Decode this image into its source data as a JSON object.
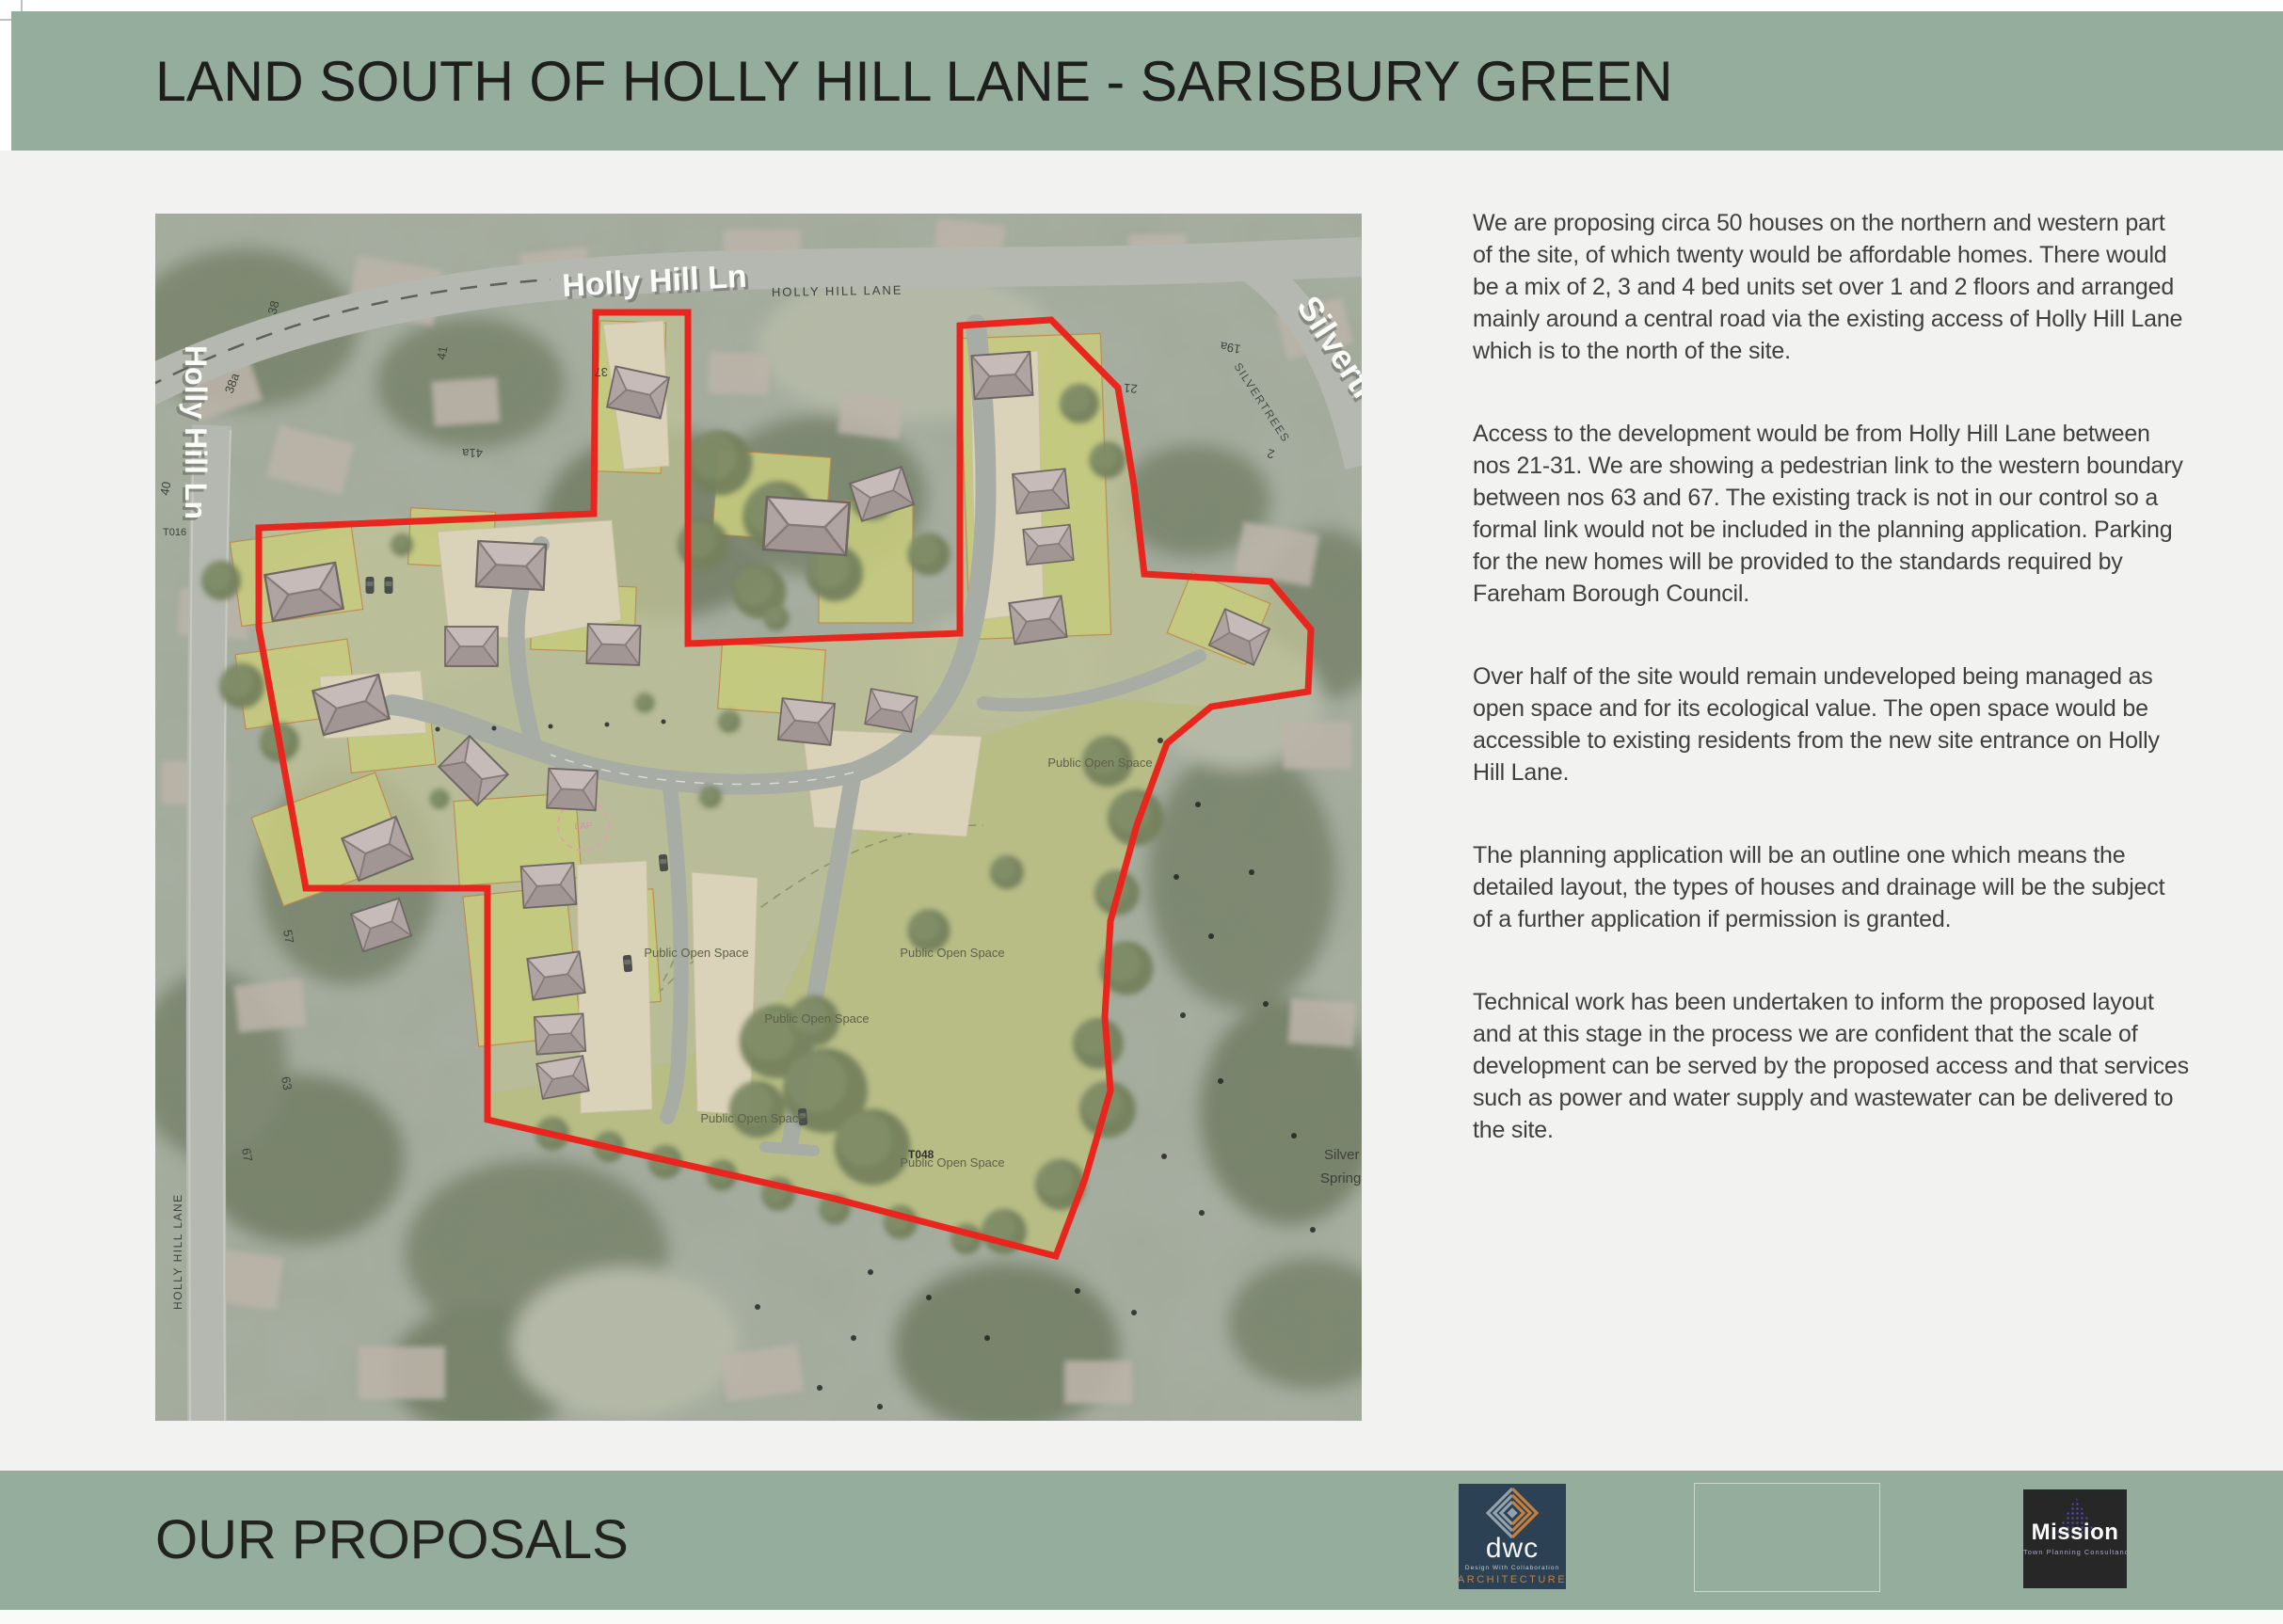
{
  "header": {
    "title": "LAND SOUTH OF HOLLY HILL LANE - SARISBURY GREEN"
  },
  "footer": {
    "title": "OUR PROPOSALS"
  },
  "proposals": {
    "paragraphs": [
      "We are proposing circa 50 houses on the northern and western part of the site, of which twenty would be affordable homes. There would be a mix of 2, 3 and 4 bed units set over 1 and 2 floors and arranged mainly around a central road via the existing access of Holly Hill Lane which is to the north of the site.",
      "Access to the development would be from Holly Hill Lane between nos 21-31. We are showing a pedestrian link to the western boundary between nos 63 and 67. The existing track is not in our control so a formal link would not be included in the planning application. Parking for the new homes will be provided to the standards required by Fareham Borough Council.",
      "Over half of the site would remain undeveloped being managed as open space and for its ecological value. The open space would be accessible to existing residents from the new site entrance on Holly Hill Lane.",
      "The planning application will be an outline one which means the detailed layout, the types of houses and drainage will be the subject of a further application if permission is granted.",
      "Technical work has been undertaken to inform the proposed layout and at this stage in the process we are confident that the scale of development can be served by the proposed access and that services such as power and water supply and wastewater can be delivered to the site."
    ]
  },
  "map": {
    "labels": {
      "holly_hill_ln_3d": "Holly Hill Ln",
      "holly_hill_lane_small": "HOLLY HILL LANE",
      "silvertrees_3d": "Silvertrees",
      "silvertrees_small": "SILVERTREES",
      "silver_spring_line1": "Silver",
      "silver_spring_line2": "Spring",
      "open_space": "Public Open Space",
      "lap": "LAP"
    },
    "house_numbers": {
      "n38": "38",
      "n38a": "38a",
      "n40": "40",
      "n41": "41",
      "n41a": "41a",
      "n37": "37",
      "n57": "57",
      "n63": "63",
      "n67": "67",
      "n21": "21",
      "n19a": "19a",
      "n2": "2"
    },
    "tree_tags": {
      "t016": "T016",
      "t048": "T048"
    }
  },
  "logos": {
    "dwc": {
      "name": "dwc",
      "tagline": "Design With Collaboration",
      "field": "ARCHITECTURE"
    },
    "mission": {
      "name": "Mission",
      "tagline": "Town Planning Consultancy"
    }
  },
  "colors": {
    "band_green": "#95ad9c",
    "page_bg": "#f2f3f1",
    "boundary_red": "#e8261d",
    "dwc_navy": "#2d4154",
    "dwc_orange": "#c5803d",
    "mission_dark": "#272727",
    "mission_purple": "#5a4fd0"
  }
}
